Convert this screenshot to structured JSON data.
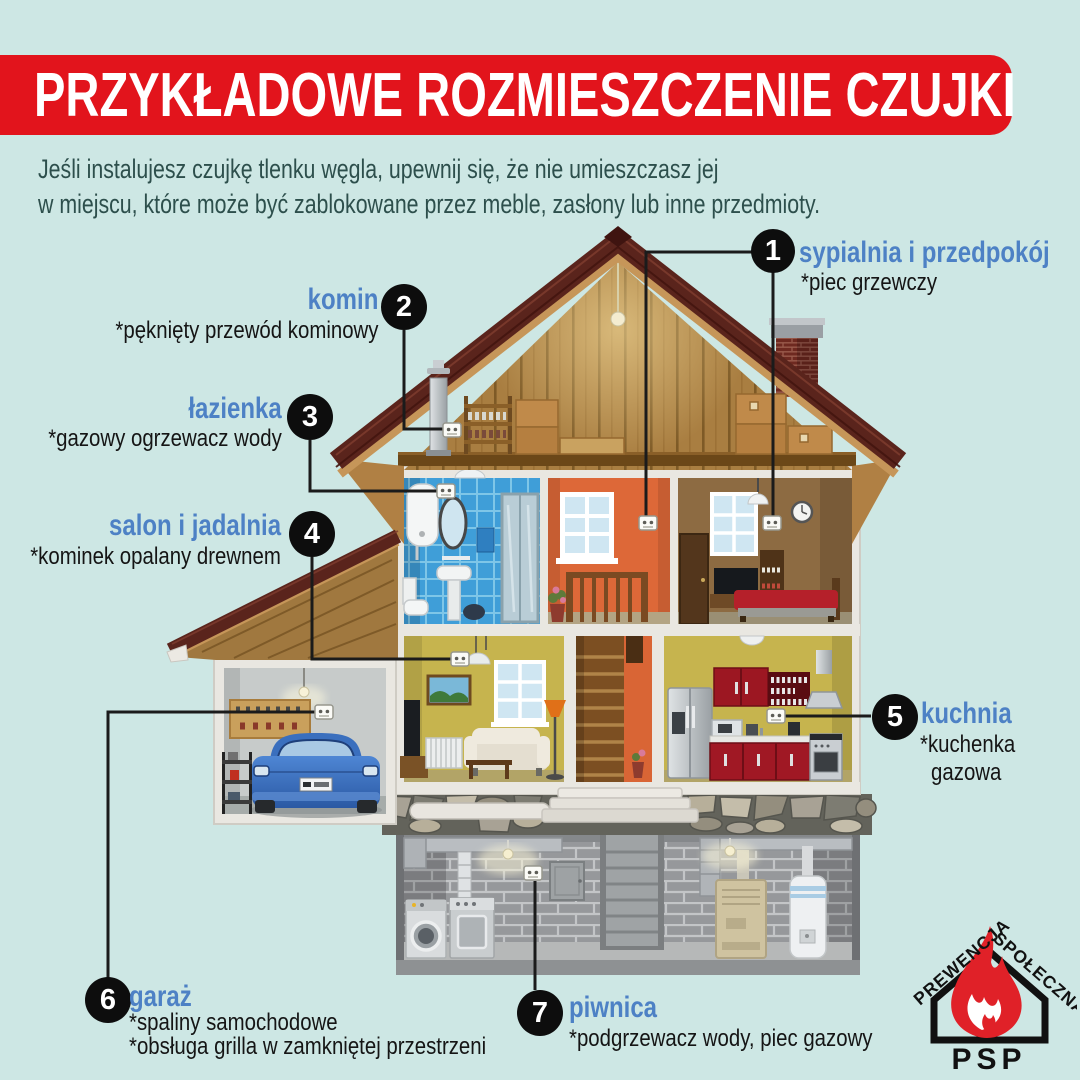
{
  "colors": {
    "background": "#cde7e4",
    "banner_red": "#e2141c",
    "label_blue": "#4d81c5",
    "intro_text": "#2d4f4c",
    "note_black": "#151515",
    "callout_circle": "#0d0d0d",
    "logo_flame_red": "#e02128"
  },
  "header": {
    "title": "PRZYKŁADOWE ROZMIESZCZENIE CZUJKI"
  },
  "intro": {
    "line1": "Jeśli instalujesz czujkę tlenku węgla, upewnij się, że nie umieszczasz jej",
    "line2": "w miejscu, które może być zablokowane przez meble, zasłony lub inne przedmioty."
  },
  "callouts": [
    {
      "number": "1",
      "label": "sypialnia i przedpokój",
      "notes": [
        "*piec grzewczy"
      ]
    },
    {
      "number": "2",
      "label": "komin",
      "notes": [
        "*pęknięty przewód kominowy"
      ]
    },
    {
      "number": "3",
      "label": "łazienka",
      "notes": [
        "*gazowy ogrzewacz wody"
      ]
    },
    {
      "number": "4",
      "label": "salon i jadalnia",
      "notes": [
        "*kominek opalany drewnem"
      ]
    },
    {
      "number": "5",
      "label": "kuchnia",
      "notes": [
        "*kuchenka",
        "gazowa"
      ]
    },
    {
      "number": "6",
      "label": "garaż",
      "notes": [
        "*spaliny samochodowe",
        "*obsługa grilla w zamkniętej przestrzeni"
      ]
    },
    {
      "number": "7",
      "label": "piwnica",
      "notes": [
        "*podgrzewacz wody, piec gazowy"
      ]
    }
  ],
  "logo": {
    "arc_left": "PREWENCJA",
    "arc_right": "SPOŁECZNA",
    "abbr": "PSP"
  }
}
